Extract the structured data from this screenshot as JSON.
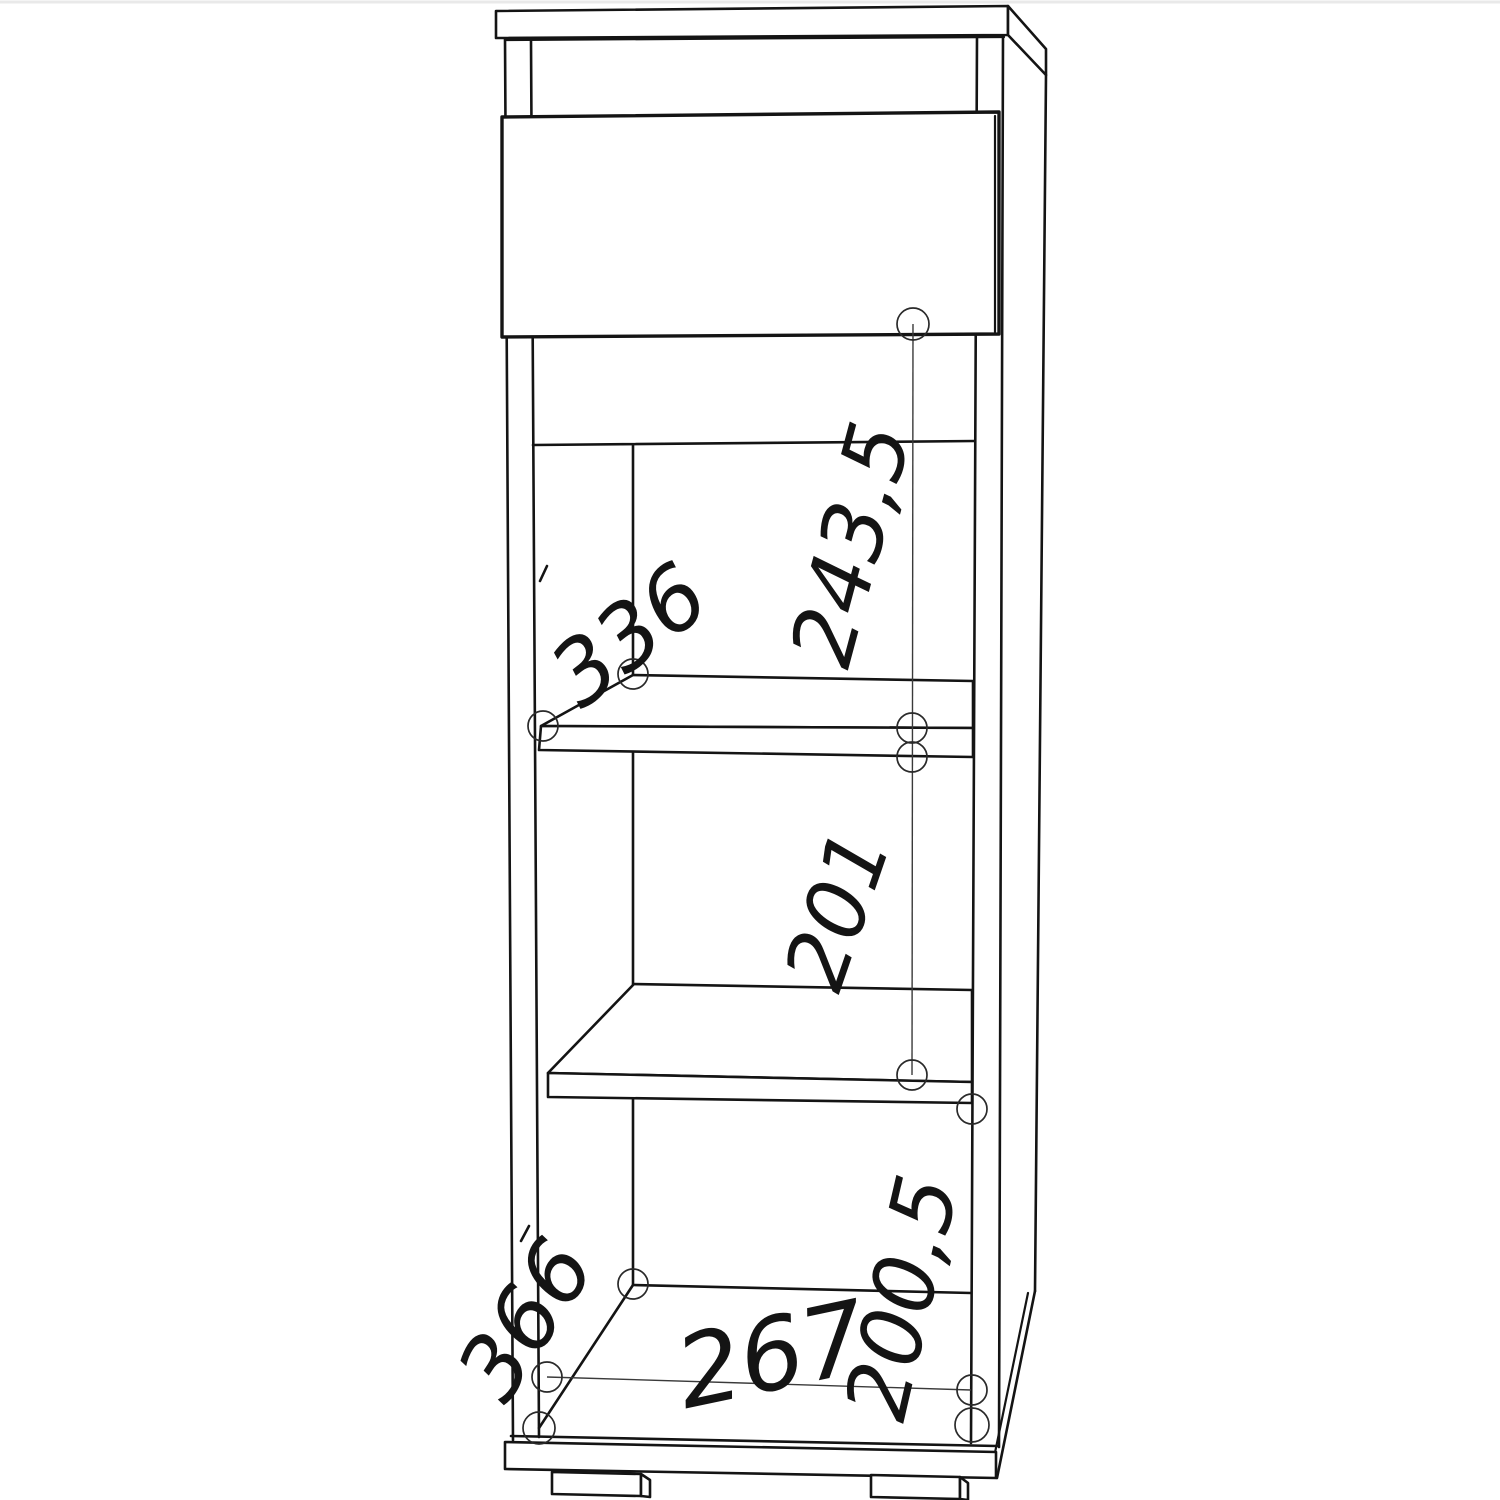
{
  "drawing": {
    "background": "#ffffff",
    "ink": "#141414",
    "type": "furniture-technical-drawing",
    "object": "tall-cabinet-with-drawer-and-two-shelves",
    "dimension_labels": {
      "shelf_opening_width_336": "336",
      "drawer_to_shelf_243_5": "243,5",
      "shelf_to_shelf_201": "201",
      "shelf_to_bottom_200_5": "200,5",
      "bottom_opening_width_267": "267",
      "bottom_depth_366": "366"
    }
  }
}
